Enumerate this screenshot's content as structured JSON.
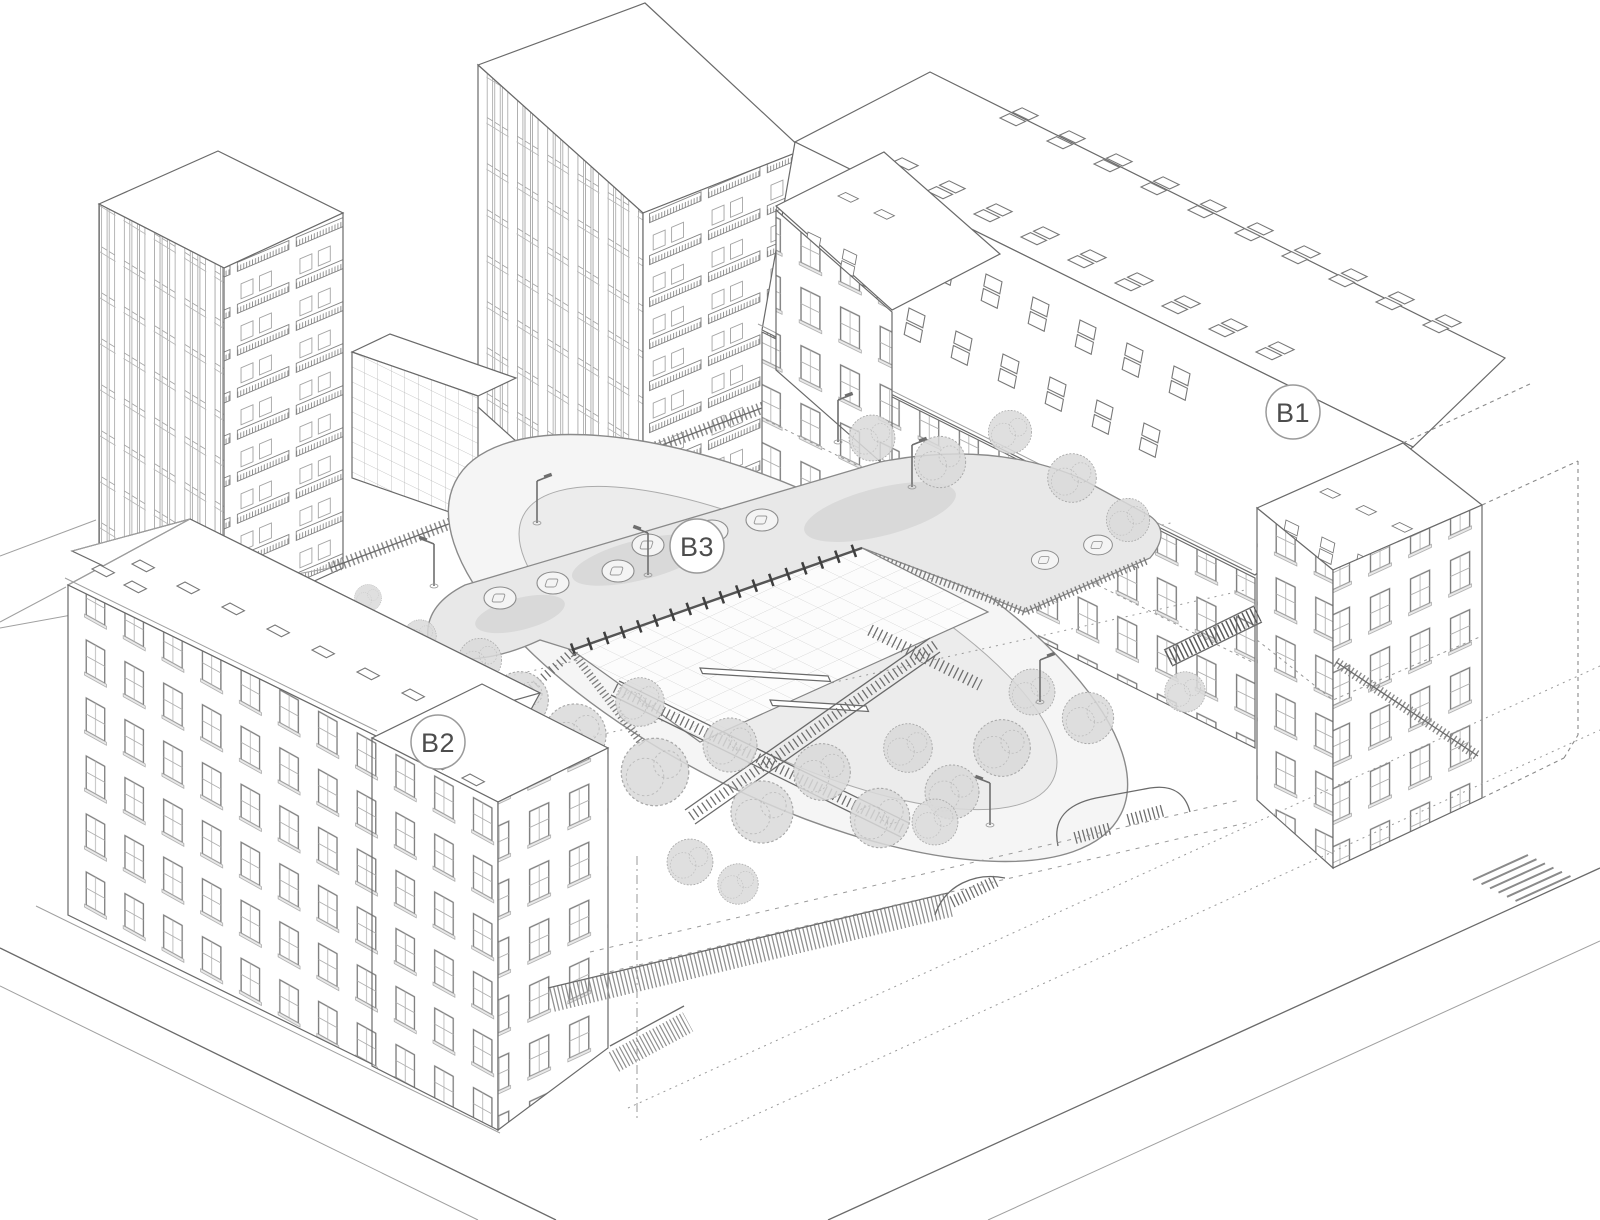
{
  "meta": {
    "type": "axonometric-architectural-site-drawing",
    "description": "Line drawing of a school ensemble: two long historic wings B1 and B2, a sunken courtyard pavilion B3 with green roof, two background towers, tree-filled courtyard and surrounding streets"
  },
  "labels": {
    "b1": "B1",
    "b2": "B2",
    "b3": "B3"
  },
  "palette": {
    "background": "#ffffff",
    "line": "#6a6a6a",
    "line_light": "#a0a0a0",
    "roof_fill": "#ffffff",
    "b3_roof": "#e8e8e8",
    "b3_roof_shade": "#d9d9d9",
    "court_outer": "#f5f5f5",
    "court_lawn": "#ececec",
    "tree_canopy": "#d9d9d9",
    "label_text": "#4d4d4d",
    "label_ring": "#9a9a9a"
  }
}
